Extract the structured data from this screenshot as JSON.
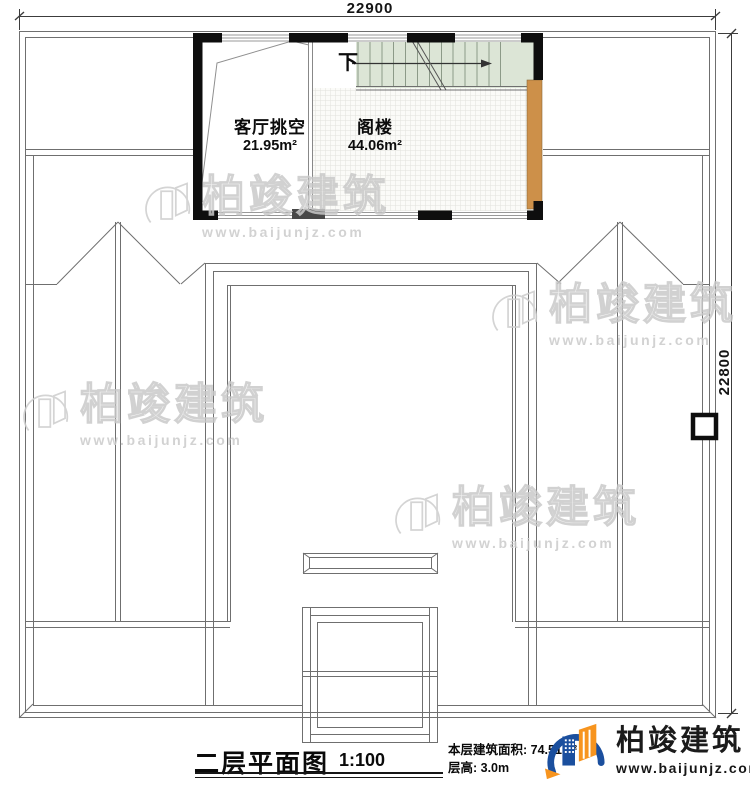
{
  "dimensions": {
    "top": "22900",
    "right": "22800"
  },
  "rooms": [
    {
      "name": "客厅挑空",
      "area": "21.95m²"
    },
    {
      "name": "阁楼",
      "area": "44.06m²"
    }
  ],
  "stairs": {
    "direction_label": "下"
  },
  "title_block": {
    "plan_title": "二层平面图",
    "scale": "1:100",
    "area_line": "本层建筑面积: 74.51m²",
    "height_line": "层高: 3.0m"
  },
  "branding": {
    "company_name": "柏竣建筑",
    "website": "www.baijunjz.com"
  },
  "watermark": {
    "name": "柏竣建筑",
    "url": "www.baijunjz.com"
  },
  "icons": {
    "logo_icon": "building-swoosh-icon",
    "watermark_icon": "building-swoosh-outline-icon",
    "stair_arrow": "right-arrow-icon"
  },
  "colors": {
    "wall": "#0e0e0e",
    "thin_line": "#6f6f6f",
    "stair_fill": "#dce5d6",
    "wood_fill": "#cd9049",
    "door_fill": "#484848",
    "logo_blue": "#1b4f9e",
    "logo_orange": "#f7941e",
    "watermark_gray": "#c9c9c9"
  }
}
